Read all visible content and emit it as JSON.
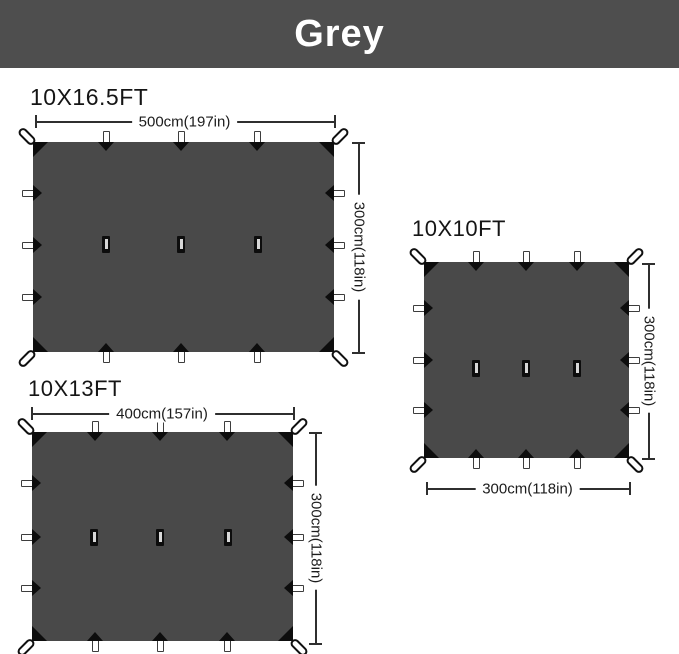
{
  "banner": {
    "label": "Grey"
  },
  "colors": {
    "page_bg": "#ffffff",
    "banner_bg": "#4e4e4e",
    "banner_text": "#ffffff",
    "tarp_fill": "#494949",
    "hardware_black": "#0d0d0d",
    "webbing_white": "#ffffff",
    "dim_line": "#2f2f2f"
  },
  "tarps": [
    {
      "name": "10X16.5FT",
      "width_label": "500cm(197in)",
      "height_label": "300cm(118in)",
      "top_tabs": 3,
      "bottom_tabs": 3,
      "left_tabs": 3,
      "right_tabs": 3,
      "center_slots": 3,
      "corner_loops": 4
    },
    {
      "name": "10X10FT",
      "width_label": "300cm(118in)",
      "height_label": "300cm(118in)",
      "top_tabs": 3,
      "bottom_tabs": 3,
      "left_tabs": 3,
      "right_tabs": 3,
      "center_slots": 3,
      "corner_loops": 4
    },
    {
      "name": "10X13FT",
      "width_label": "400cm(157in)",
      "height_label": "300cm(118in)",
      "top_tabs": 3,
      "bottom_tabs": 3,
      "left_tabs": 3,
      "right_tabs": 3,
      "center_slots": 3,
      "corner_loops": 4
    }
  ]
}
